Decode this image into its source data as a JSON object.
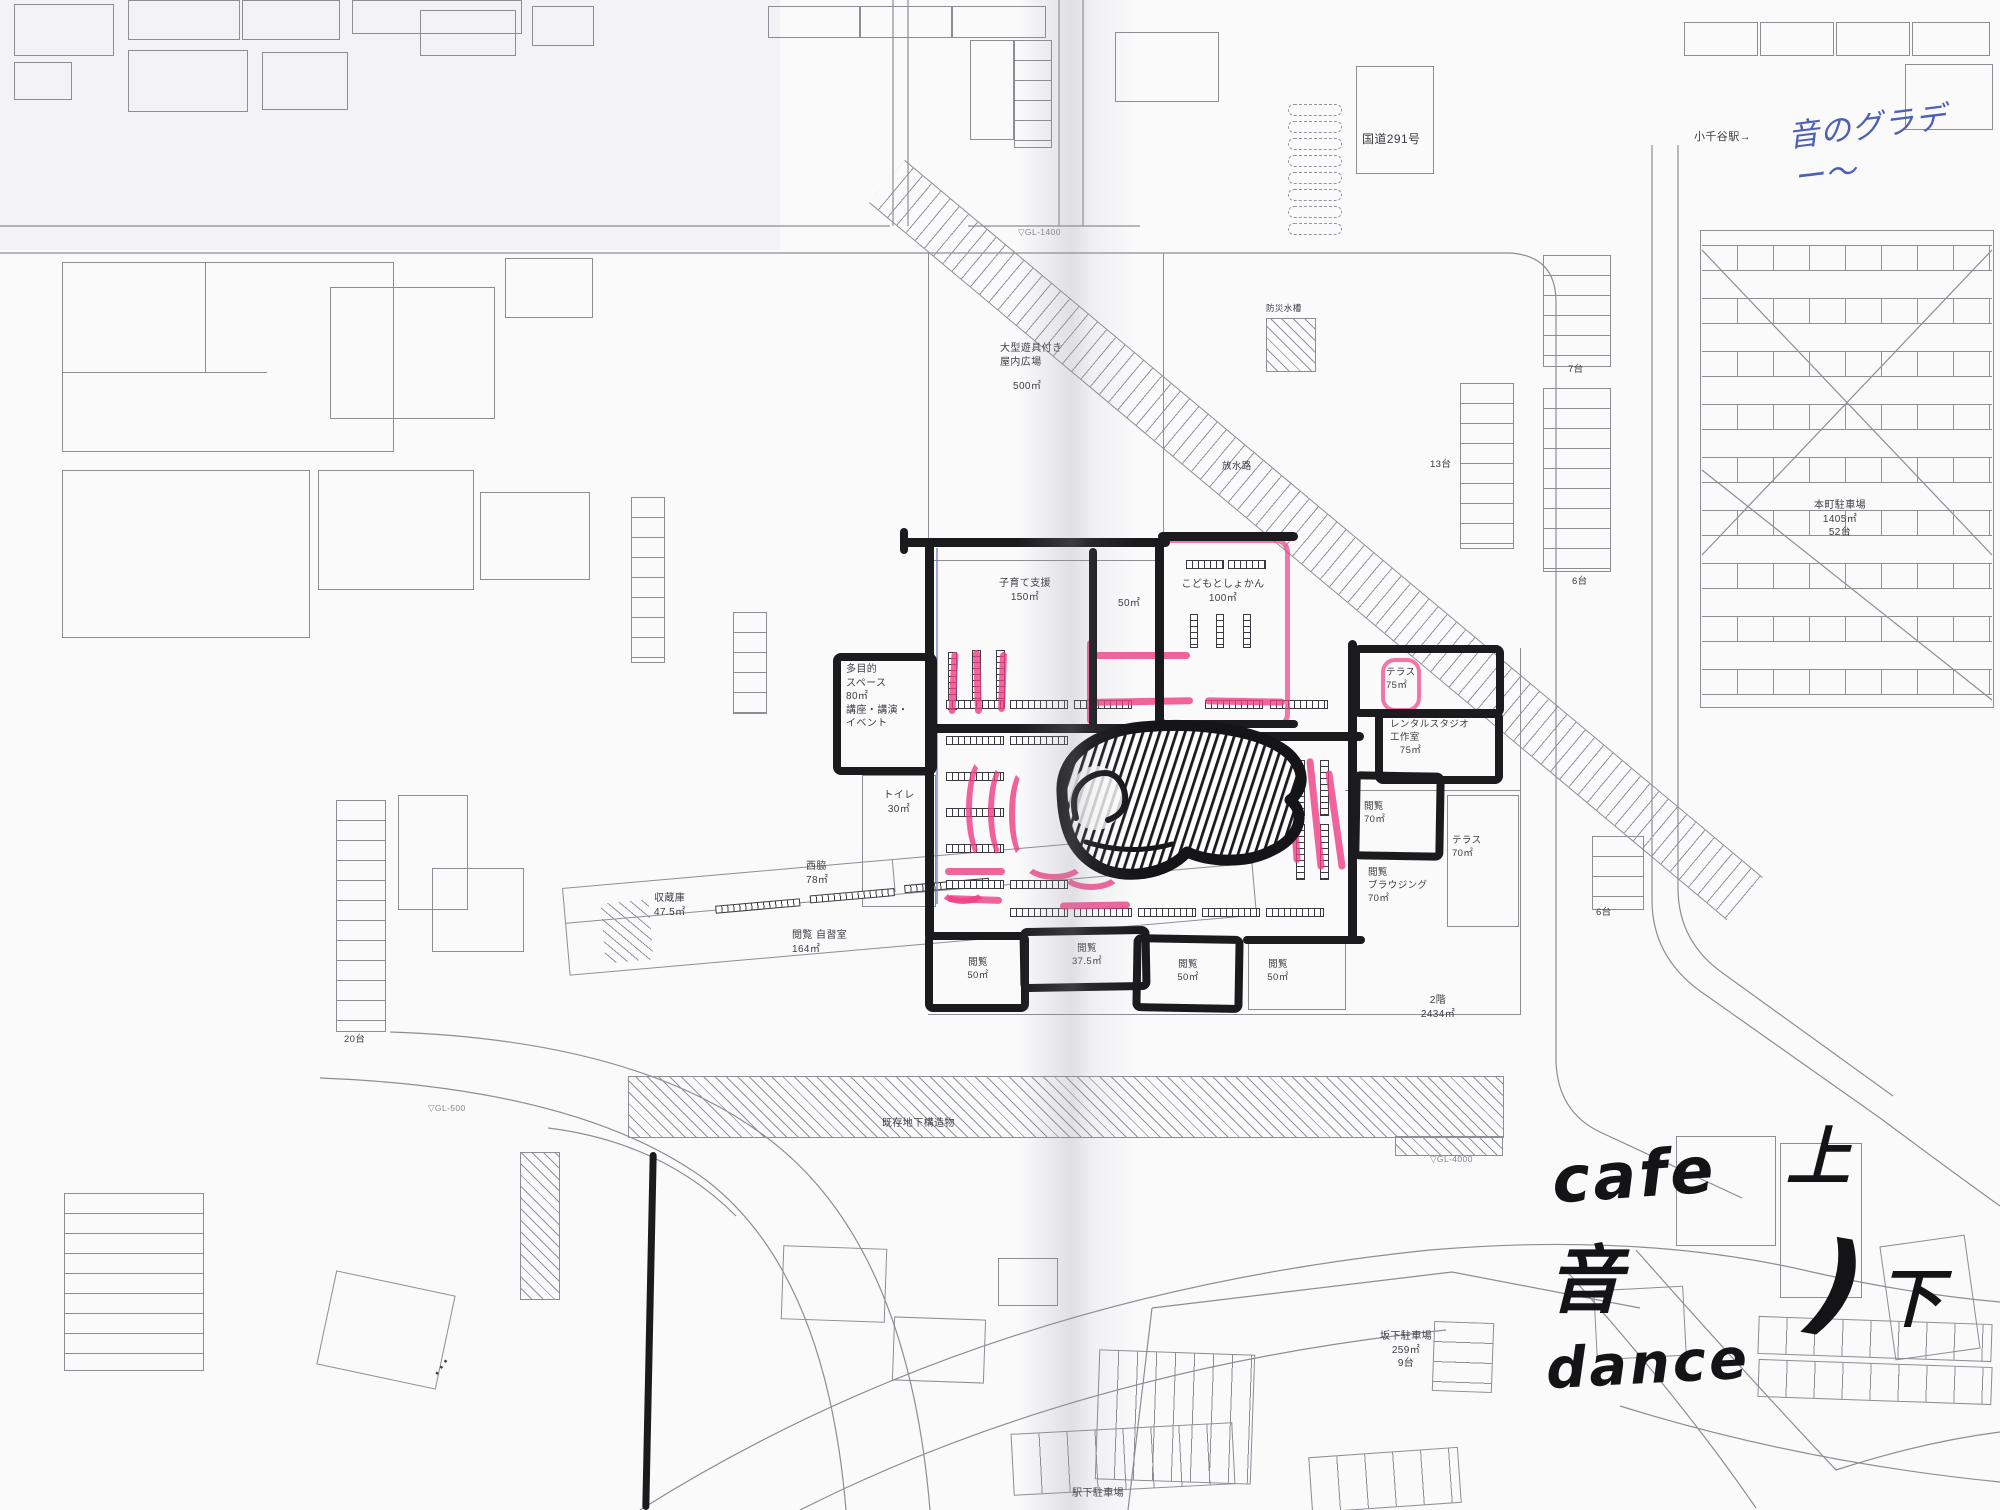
{
  "meta": {
    "description": "Scanned architectural site/floor plan of a library block with hand-drawn black marker room sketch, pink highlighter strokes and handwritten notes"
  },
  "colors": {
    "plan_line": "#8d8d94",
    "marker_black": "#1b1b1e",
    "pink_highlight": "#ef3d83",
    "blue_pen": "#6b79c8",
    "handwriting_blue": "#4c60b8",
    "paper": "#fafafb"
  },
  "labels": [
    {
      "n": "label-route-291",
      "t": "国道291号",
      "x": 1362,
      "y": 131,
      "fs": 12
    },
    {
      "n": "label-ojiya-station",
      "t": "小千谷駅→",
      "x": 1694,
      "y": 130,
      "fs": 11
    },
    {
      "n": "note-blue-sound-gradation",
      "t": "音のグラデー〜",
      "x": 1790,
      "y": 104,
      "fs": 31,
      "r": -7,
      "s": "hu"
    },
    {
      "n": "label-gl-1400",
      "t": "▽GL-1400",
      "x": 1018,
      "y": 227,
      "fs": 8.5,
      "s": "lg"
    },
    {
      "n": "label-disaster-tank",
      "t": "防災水槽",
      "x": 1266,
      "y": 303,
      "fs": 8.5
    },
    {
      "n": "label-indoor-plaza",
      "t": "大型遊具付き\n屋内広場",
      "x": 1000,
      "y": 342,
      "fs": 10
    },
    {
      "n": "label-indoor-plaza-area",
      "t": "500㎡",
      "x": 1013,
      "y": 380,
      "fs": 10
    },
    {
      "n": "label-drainage-channel",
      "t": "放水路",
      "x": 1222,
      "y": 461,
      "fs": 9.5
    },
    {
      "n": "label-parking-7",
      "t": "7台",
      "x": 1568,
      "y": 364,
      "fs": 9.5
    },
    {
      "n": "label-parking-13",
      "t": "13台",
      "x": 1430,
      "y": 459,
      "fs": 9.5
    },
    {
      "n": "label-parking-6a",
      "t": "6台",
      "x": 1572,
      "y": 576,
      "fs": 9.5
    },
    {
      "n": "label-honcho-parking",
      "t": "本町駐車場\n1405㎡\n52台",
      "x": 1790,
      "y": 499,
      "fs": 10,
      "w": 100,
      "ta": "center"
    },
    {
      "n": "label-childcare-room",
      "t": "子育て支援\n150㎡",
      "x": 982,
      "y": 577,
      "fs": 10,
      "w": 86,
      "ta": "center"
    },
    {
      "n": "label-room-50",
      "t": "50㎡",
      "x": 1118,
      "y": 597,
      "fs": 10
    },
    {
      "n": "label-children-library",
      "t": "こどもとしょかん\n100㎡",
      "x": 1173,
      "y": 578,
      "fs": 10,
      "w": 100,
      "ta": "center"
    },
    {
      "n": "label-multipurpose-space",
      "t": "多目的\nスペース\n80㎡\n講座・講演・\nイベント",
      "x": 846,
      "y": 663,
      "fs": 10
    },
    {
      "n": "label-terrace-75",
      "t": "テラス\n75㎡",
      "x": 1386,
      "y": 667,
      "fs": 9.5
    },
    {
      "n": "label-rental-studio",
      "t": "レンタルスタジオ\n工作室\n　75㎡",
      "x": 1390,
      "y": 719,
      "fs": 9.5
    },
    {
      "n": "label-toilet",
      "t": "トイレ\n30㎡",
      "x": 872,
      "y": 789,
      "fs": 10,
      "w": 54,
      "ta": "center"
    },
    {
      "n": "label-reading-70",
      "t": "閲覧\n70㎡",
      "x": 1364,
      "y": 801,
      "fs": 9.5
    },
    {
      "n": "label-terrace-70",
      "t": "テラス\n70㎡",
      "x": 1452,
      "y": 835,
      "fs": 9.5
    },
    {
      "n": "label-reading-browsing",
      "t": "閲覧\nブラウジング\n70㎡",
      "x": 1368,
      "y": 867,
      "fs": 9.5
    },
    {
      "n": "label-parking-6b",
      "t": "6台",
      "x": 1596,
      "y": 907,
      "fs": 9.5
    },
    {
      "n": "label-storage",
      "t": "収蔵庫\n47.5㎡",
      "x": 654,
      "y": 892,
      "fs": 10
    },
    {
      "n": "label-nishiwaki",
      "t": "西脇\n78㎡",
      "x": 806,
      "y": 860,
      "fs": 10
    },
    {
      "n": "label-reading-study-room",
      "t": "閲覧 自習室\n164㎡",
      "x": 792,
      "y": 929,
      "fs": 10
    },
    {
      "n": "label-reading-50a",
      "t": "閲覧\n50㎡",
      "x": 954,
      "y": 957,
      "fs": 9.5,
      "w": 48,
      "ta": "center"
    },
    {
      "n": "label-reading-37-5",
      "t": "閲覧\n37.5㎡",
      "x": 1058,
      "y": 943,
      "fs": 9.5,
      "w": 58,
      "ta": "center"
    },
    {
      "n": "label-reading-50b",
      "t": "閲覧\n50㎡",
      "x": 1164,
      "y": 959,
      "fs": 9.5,
      "w": 48,
      "ta": "center"
    },
    {
      "n": "label-reading-50c",
      "t": "閲覧\n50㎡",
      "x": 1254,
      "y": 959,
      "fs": 9.5,
      "w": 48,
      "ta": "center"
    },
    {
      "n": "label-2f-total-area",
      "t": "2階\n2434㎡",
      "x": 1410,
      "y": 994,
      "fs": 10,
      "w": 56,
      "ta": "center"
    },
    {
      "n": "label-parking-20",
      "t": "20台",
      "x": 344,
      "y": 1034,
      "fs": 9.5
    },
    {
      "n": "label-gl-500",
      "t": "▽GL-500",
      "x": 428,
      "y": 1103,
      "fs": 8.5,
      "s": "lg"
    },
    {
      "n": "label-underground-structure",
      "t": "既存地下構造物",
      "x": 882,
      "y": 1117,
      "fs": 10
    },
    {
      "n": "label-gl-4000",
      "t": "▽GL-4000",
      "x": 1430,
      "y": 1154,
      "fs": 8.5,
      "s": "lg"
    },
    {
      "n": "label-sakashita-parking",
      "t": "坂下駐車場\n259㎡\n9台",
      "x": 1360,
      "y": 1330,
      "fs": 10,
      "w": 92,
      "ta": "center"
    },
    {
      "n": "label-ekishita-parking",
      "t": "駅下駐車場",
      "x": 1072,
      "y": 1487,
      "fs": 10
    },
    {
      "n": "mark-dots",
      "t": "⋯",
      "x": 430,
      "y": 1352,
      "fs": 22,
      "r": -55
    },
    {
      "n": "note-cafe",
      "t": "cafe",
      "x": 1552,
      "y": 1146,
      "fs": 64,
      "r": -4,
      "s": "hb"
    },
    {
      "n": "note-up",
      "t": "上",
      "x": 1786,
      "y": 1128,
      "fs": 64,
      "s": "hb"
    },
    {
      "n": "note-sound",
      "t": "音",
      "x": 1548,
      "y": 1246,
      "fs": 74,
      "s": "hb"
    },
    {
      "n": "note-dance",
      "t": "dance",
      "x": 1546,
      "y": 1338,
      "fs": 56,
      "r": -3,
      "s": "hb"
    },
    {
      "n": "note-paren",
      "t": ")",
      "x": 1812,
      "y": 1232,
      "fs": 112,
      "r": 10,
      "s": "hb"
    },
    {
      "n": "note-down",
      "t": "下",
      "x": 1878,
      "y": 1270,
      "fs": 64,
      "s": "hb"
    }
  ]
}
